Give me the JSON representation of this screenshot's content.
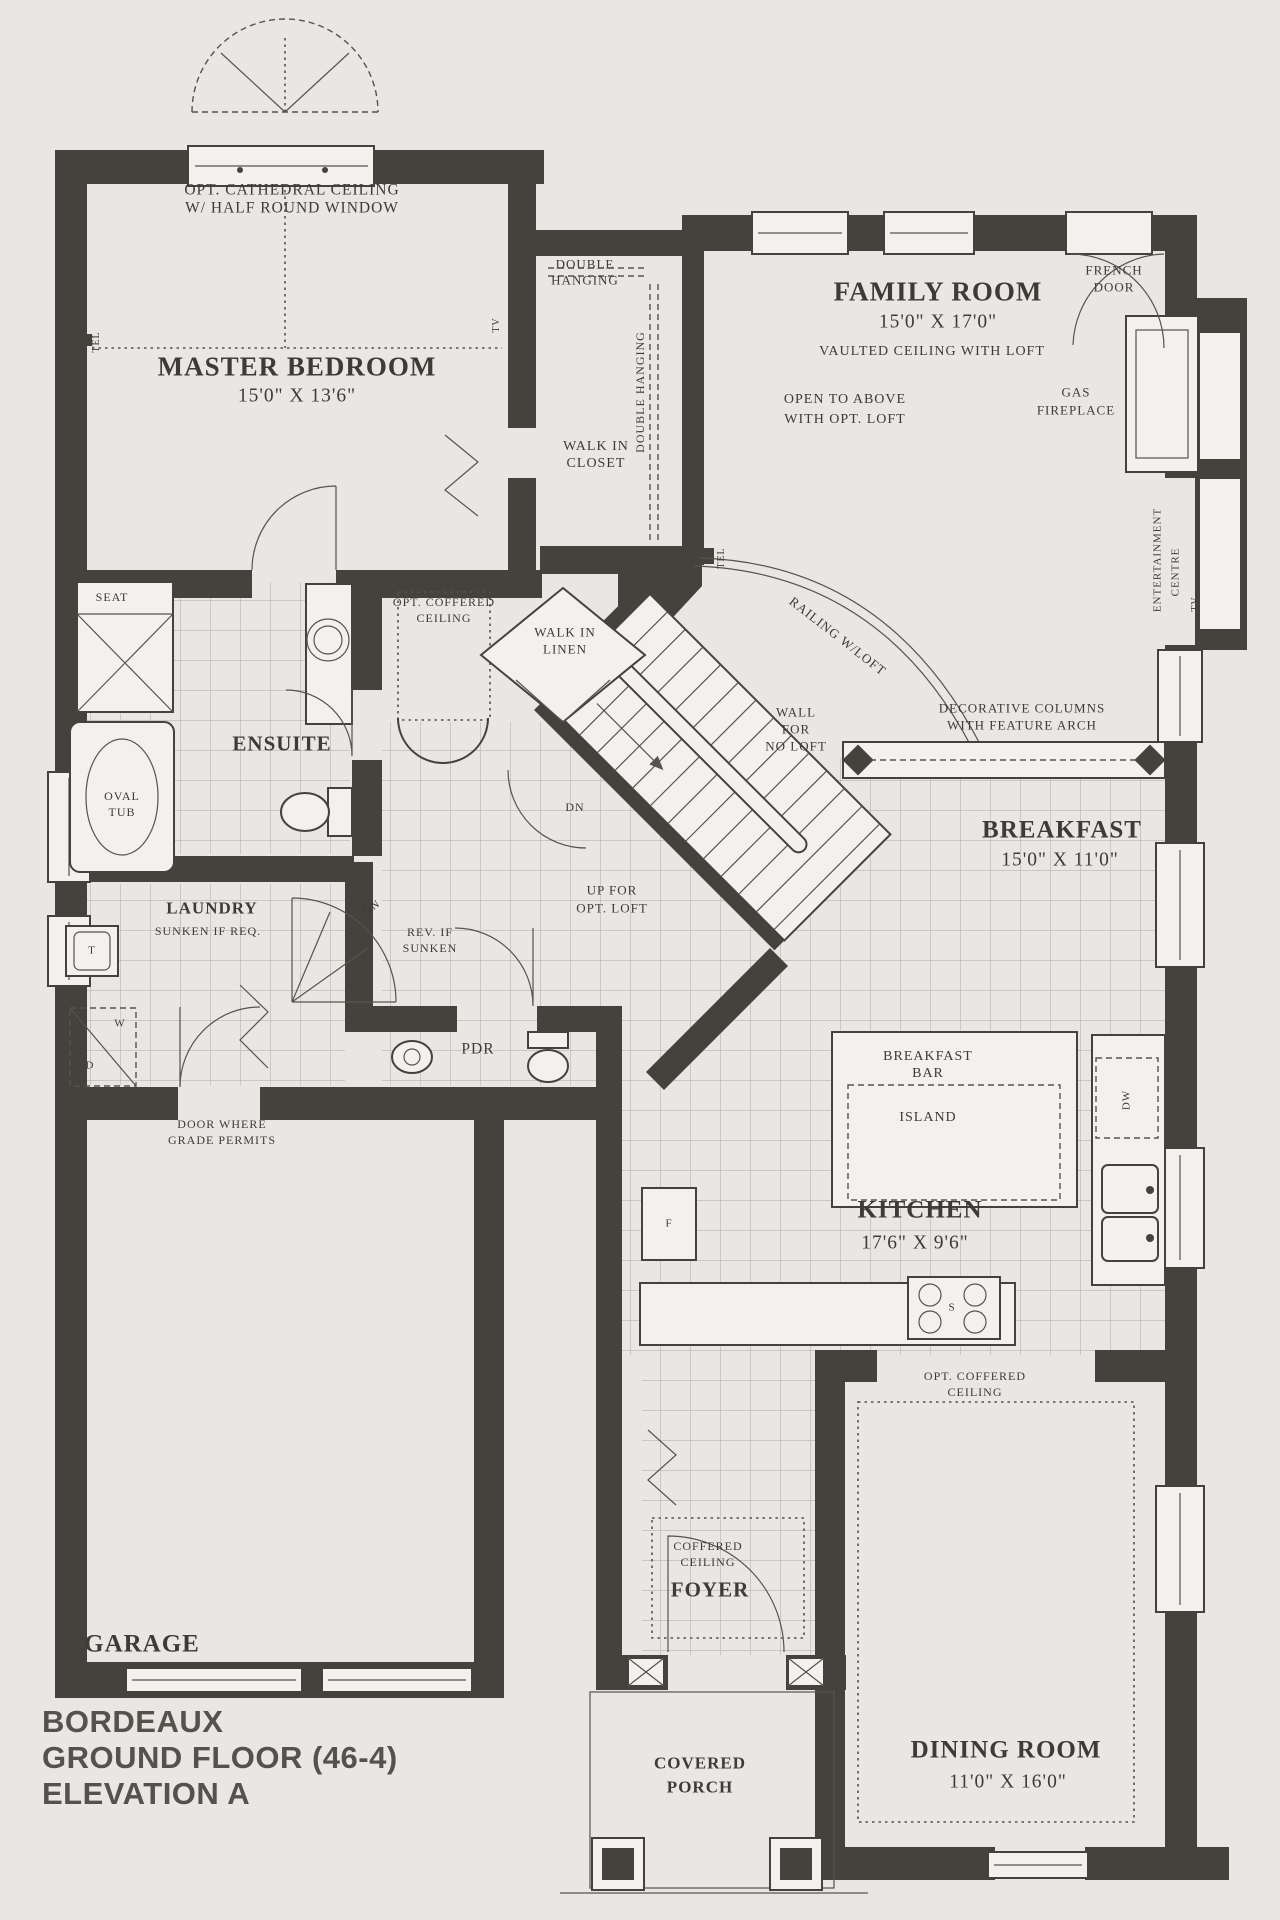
{
  "title_block": {
    "model": "BORDEAUX",
    "floor": "GROUND FLOOR (46-4)",
    "elevation": "ELEVATION A"
  },
  "master_bedroom": {
    "name": "MASTER BEDROOM",
    "dims": "15'0\" X 13'6\"",
    "ceiling_note_1": "OPT. CATHEDRAL CEILING",
    "ceiling_note_2": "W/ HALF ROUND WINDOW",
    "tel": "TEL",
    "tv": "TV"
  },
  "walk_in_closet": {
    "name_1": "WALK IN",
    "name_2": "CLOSET",
    "rod_1a": "DOUBLE",
    "rod_1b": "HANGING",
    "rod_2": "DOUBLE HANGING",
    "tel": "TEL"
  },
  "family_room": {
    "name": "FAMILY ROOM",
    "dims": "15'0\" X 17'0\"",
    "ceiling_note": "VAULTED CEILING WITH LOFT",
    "open_note_1": "OPEN TO ABOVE",
    "open_note_2": "WITH OPT. LOFT",
    "french_door_1": "FRENCH",
    "french_door_2": "DOOR",
    "fireplace_1": "GAS",
    "fireplace_2": "FIREPLACE",
    "entertainment_1": "ENTERTAINMENT",
    "entertainment_2": "CENTRE",
    "tv": "TV"
  },
  "ensuite": {
    "name": "ENSUITE",
    "seat": "SEAT",
    "tub_1": "OVAL",
    "tub_2": "TUB"
  },
  "hall": {
    "ceiling_1": "OPT. COFFERED",
    "ceiling_2": "CEILING",
    "linen_1": "WALK IN",
    "linen_2": "LINEN"
  },
  "stairs": {
    "railing": "RAILING W/LOFT",
    "wall_1": "WALL",
    "wall_2": "FOR",
    "wall_3": "NO LOFT",
    "dn": "DN",
    "up_1": "UP FOR",
    "up_2": "OPT. LOFT"
  },
  "breakfast": {
    "name": "BREAKFAST",
    "dims": "15'0\" X 11'0\"",
    "columns_1": "DECORATIVE COLUMNS",
    "columns_2": "WITH FEATURE ARCH"
  },
  "laundry": {
    "name": "LAUNDRY",
    "note": "SUNKEN IF REQ.",
    "tub": "T",
    "washer": "W",
    "dryer": "D",
    "dn": "DN",
    "rev_1": "REV. IF",
    "rev_2": "SUNKEN",
    "grade_1": "DOOR WHERE",
    "grade_2": "GRADE PERMITS"
  },
  "powder_room": {
    "name": "PDR"
  },
  "kitchen": {
    "name": "KITCHEN",
    "dims": "17'6\" X 9'6\"",
    "island_bar_1": "BREAKFAST",
    "island_bar_2": "BAR",
    "island": "ISLAND",
    "dishwasher": "DW",
    "stove": "S",
    "fridge": "F"
  },
  "dining_room": {
    "name": "DINING ROOM",
    "dims": "11'0\" X 16'0\"",
    "ceiling_1": "OPT. COFFERED",
    "ceiling_2": "CEILING"
  },
  "foyer": {
    "name": "FOYER",
    "ceiling_1": "COFFERED",
    "ceiling_2": "CEILING"
  },
  "garage": {
    "name": "GARAGE"
  },
  "porch": {
    "name_1": "COVERED",
    "name_2": "PORCH"
  }
}
